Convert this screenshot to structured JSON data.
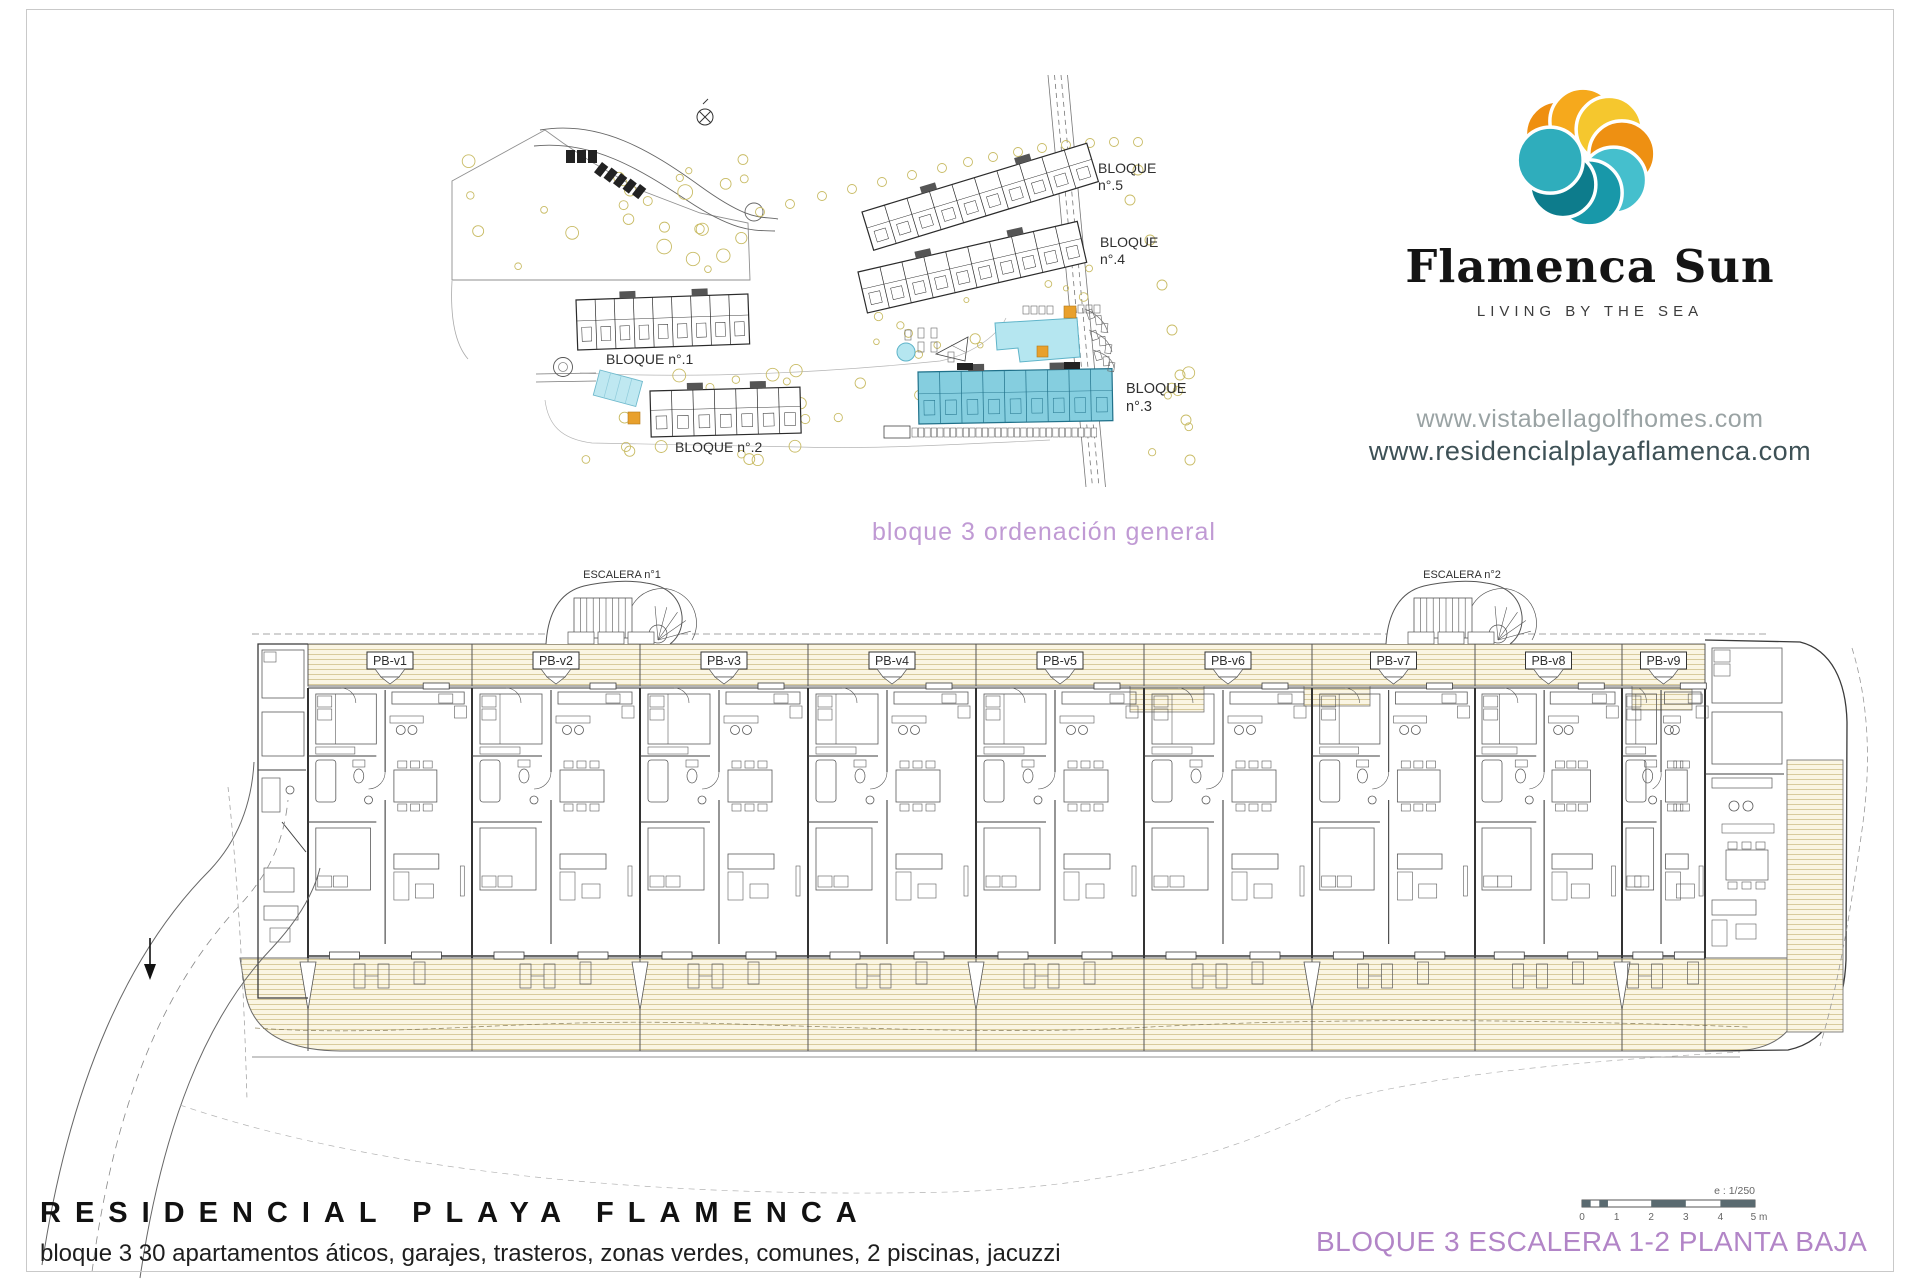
{
  "site_plan": {
    "caption": "bloque 3 ordenación general",
    "block_labels": [
      {
        "id": "bloque-1",
        "lines": [
          "BLOQUE n°.1"
        ]
      },
      {
        "id": "bloque-2",
        "lines": [
          "BLOQUE n°.2"
        ]
      },
      {
        "id": "bloque-3",
        "lines": [
          "BLOQUE",
          "n°.3"
        ]
      },
      {
        "id": "bloque-4",
        "lines": [
          "BLOQUE",
          "n°.4"
        ]
      },
      {
        "id": "bloque-5",
        "lines": [
          "BLOQUE",
          "n°.5"
        ]
      }
    ]
  },
  "brand": {
    "name": "Flamenca Sun",
    "tagline": "LIVING BY THE SEA",
    "website_1": "www.vistabellagolfhomes.com",
    "website_2": "www.residencialplayaflamenca.com",
    "logo_colors": {
      "orange": "#ef8f10",
      "amber": "#f6a91c",
      "yellow": "#f5c72e",
      "deep_orange": "#ee9012",
      "teal_light": "#45bfcd",
      "teal": "#1898a9",
      "teal_dark": "#0d7c8c",
      "teal_mid": "#2fadbc"
    }
  },
  "floor_plan": {
    "stair_labels": [
      "ESCALERA n°1",
      "ESCALERA n°2"
    ],
    "units": [
      "PB-v1",
      "PB-v2",
      "PB-v3",
      "PB-v4",
      "PB-v5",
      "PB-v6",
      "PB-v7",
      "PB-v8",
      "PB-v9"
    ]
  },
  "footer": {
    "title": "RESIDENCIAL PLAYA FLAMENCA",
    "subtitle": "bloque 3  30 apartamentos áticos, garajes, trasteros, zonas verdes, comunes, 2 piscinas, jacuzzi",
    "drawing_title": "BLOQUE 3  ESCALERA 1-2  PLANTA BAJA",
    "scale_bar": {
      "ratio_label": "e : 1/250",
      "ticks": [
        "0",
        "1",
        "2",
        "3",
        "4",
        "5 m"
      ]
    }
  },
  "colors": {
    "highlight_cyan": "#85cedf",
    "pool_cyan": "#b5e6f0",
    "accent_orange": "#e8a02c",
    "purple_text": "#b285c7",
    "deck_line": "#d5c795",
    "deck_fill": "#faf5e3"
  }
}
